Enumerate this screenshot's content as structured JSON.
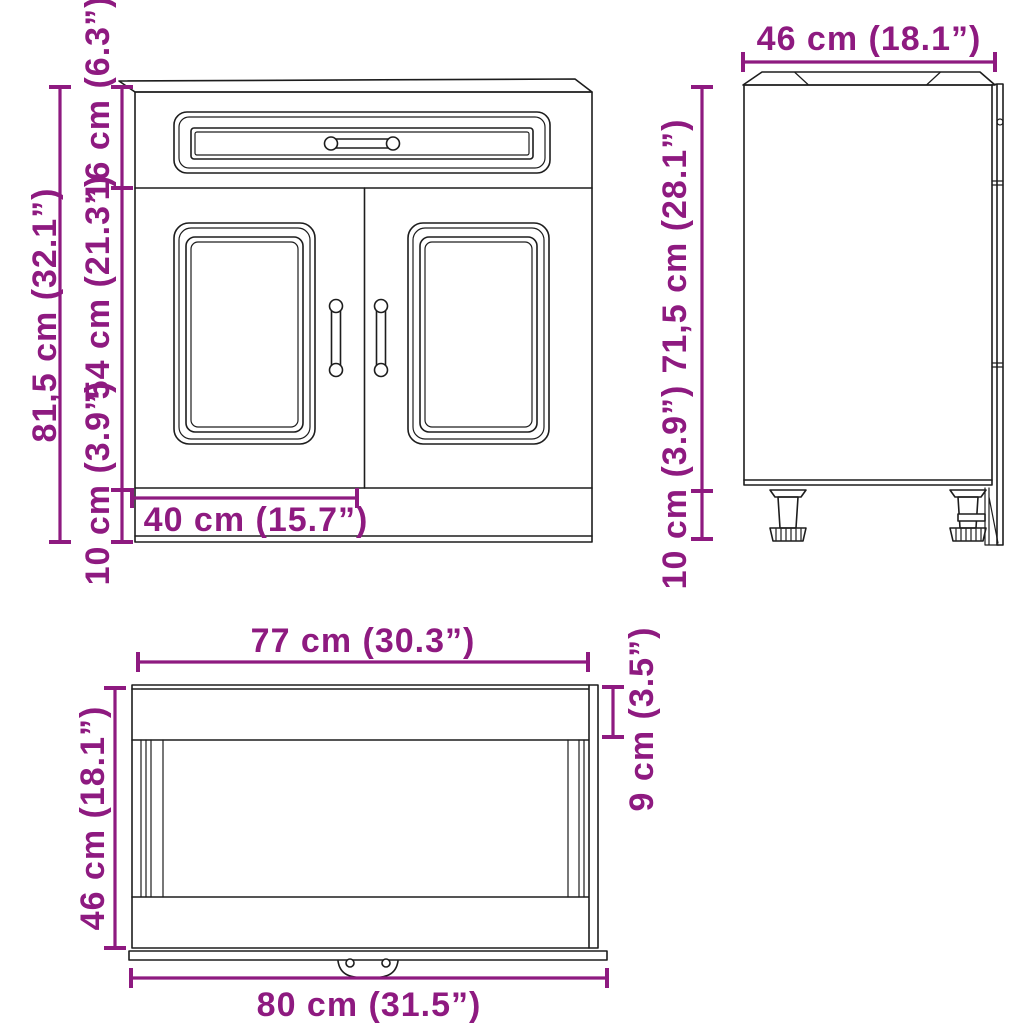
{
  "colors": {
    "dimension_accent": "#8e1a80",
    "drawing_line": "#1d1d1d",
    "background": "#ffffff"
  },
  "views": {
    "front": {
      "dims": {
        "total_height": "81,5 cm (32.1”)",
        "top_section_height": "16 cm (6.3”)",
        "door_height": "54 cm (21.3”)",
        "leg_height": "10 cm (3.9”)",
        "door_width": "40 cm (15.7”)"
      }
    },
    "side": {
      "dims": {
        "depth": "46 cm (18.1”)",
        "body_height": "71,5 cm (28.1”)",
        "leg_height": "10 cm (3.9”)"
      }
    },
    "top": {
      "dims": {
        "inner_width": "77 cm (30.3”)",
        "front_clearance": "9 cm (3.5”)",
        "depth": "46 cm (18.1”)",
        "total_width": "80 cm (31.5”)"
      }
    }
  }
}
